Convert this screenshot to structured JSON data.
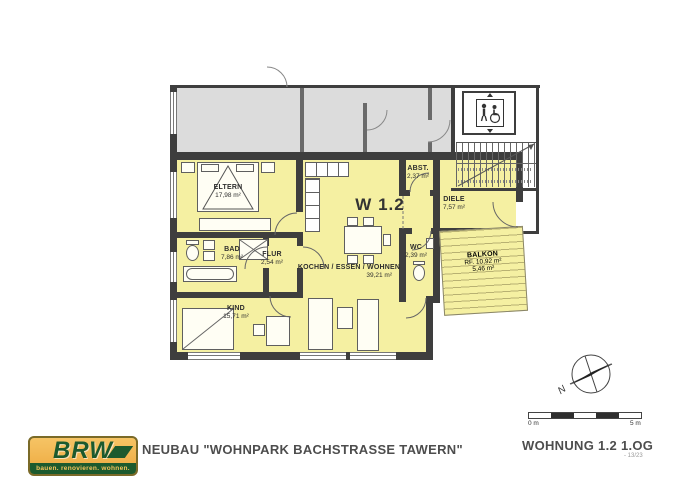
{
  "plan": {
    "unit_label": "W 1.2",
    "compass_label": "N",
    "rooms": [
      {
        "name": "ELTERN",
        "area": "17,98 m²"
      },
      {
        "name": "BAD",
        "area": "7,86 m²"
      },
      {
        "name": "FLUR",
        "area": "2,54 m²"
      },
      {
        "name": "KIND",
        "area": "15,71 m²"
      },
      {
        "name": "KOCHEN / ESSEN / WOHNEN",
        "area": "39,21 m²"
      },
      {
        "name": "ABST.",
        "area": "2,37 m²"
      },
      {
        "name": "WC",
        "area": "2,39 m²"
      },
      {
        "name": "DIELE",
        "area": "7,57 m²"
      },
      {
        "name": "BALKON",
        "rf": "RF. 10,92 m²",
        "area": "5,46 m²"
      }
    ],
    "scalebar": {
      "start": "0 m",
      "end": "5 m"
    }
  },
  "footer": {
    "logo_text": "BRW",
    "logo_tagline": "bauen. renovieren. wohnen.",
    "project_title": "NEUBAU \"WOHNPARK BACHSTRASSE TAWERN\"",
    "unit_title": "WOHNUNG 1.2  1.OG",
    "page_ref": "- 13/23"
  },
  "colors": {
    "unit_fill": "#f5f0a2",
    "neighbor_fill": "#dcdcdc",
    "wall": "#3e3e3e",
    "logo_green": "#1c5a2e",
    "logo_orange": "#f0b54d"
  }
}
